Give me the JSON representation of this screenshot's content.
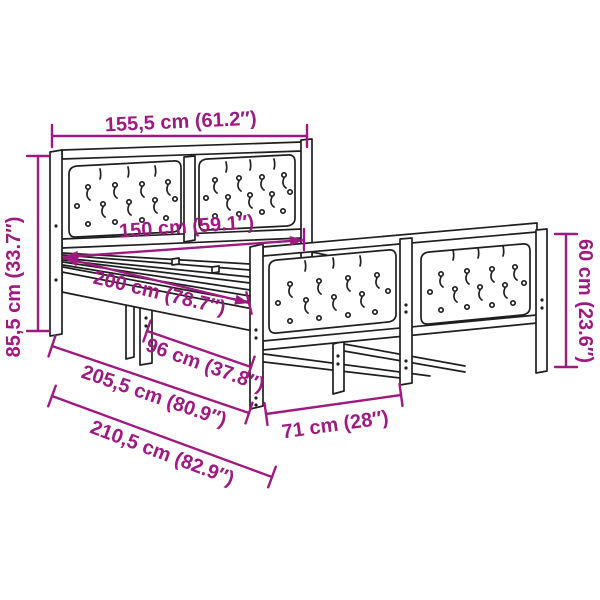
{
  "diagram": {
    "subject": "bed-frame-with-headboard-and-footboard-dimension-diagram",
    "style": {
      "dimension_color": "#9e1a80",
      "line_color": "#1f1f1f",
      "background": "#ffffff"
    },
    "dimensions": [
      {
        "id": "overall-width",
        "label": "155,5 cm (61.2″)"
      },
      {
        "id": "headboard-height",
        "label": "85,5 cm (33.7″)"
      },
      {
        "id": "inner-width",
        "label": "150 cm (59.1″)"
      },
      {
        "id": "inner-length",
        "label": "200 cm (78.7″)"
      },
      {
        "id": "underbed-span",
        "label": "96 cm (37.8″)"
      },
      {
        "id": "frame-length",
        "label": "205,5 cm (80.9″)"
      },
      {
        "id": "overall-length",
        "label": "210,5 cm (82.9″)"
      },
      {
        "id": "footboard-section-width",
        "label": "71 cm (28″)"
      },
      {
        "id": "footboard-height",
        "label": "60 cm (23.6″)"
      }
    ]
  }
}
